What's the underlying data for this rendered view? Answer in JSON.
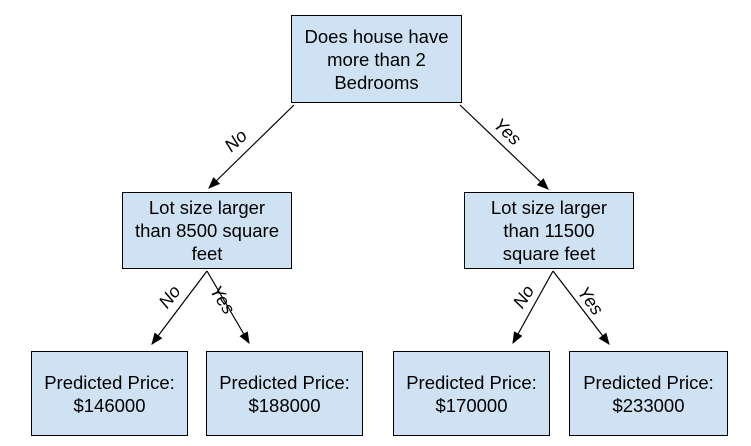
{
  "colors": {
    "node_fill": "#cfe2f3",
    "node_border": "#000000",
    "edge": "#000000",
    "background": "#ffffff"
  },
  "nodes": {
    "root": "Does house have\nmore than 2\nBedrooms",
    "left": "Lot size larger\nthan 8500 square\nfeet",
    "right": "Lot size larger\nthan 11500\nsquare feet",
    "leaf_left_no": "Predicted Price:\n$146000",
    "leaf_left_yes": "Predicted Price:\n$188000",
    "leaf_right_no": "Predicted Price:\n$170000",
    "leaf_right_yes": "Predicted Price:\n$233000"
  },
  "edges": {
    "root_to_left": "No",
    "root_to_right": "Yes",
    "left_to_leaf_no": "No",
    "left_to_leaf_yes": "Yes",
    "right_to_leaf_no": "No",
    "right_to_leaf_yes": "Yes"
  }
}
